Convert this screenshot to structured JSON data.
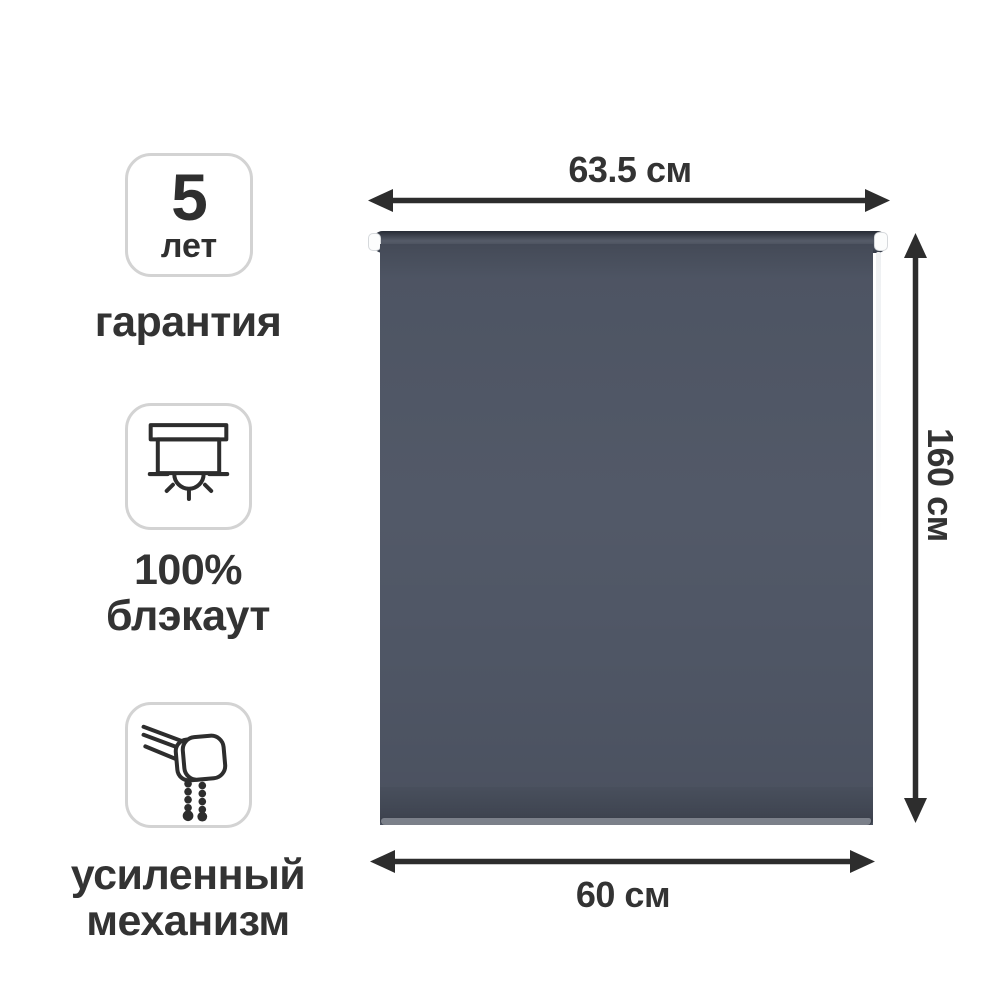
{
  "page": {
    "type": "product-infographic",
    "background": "#ffffff"
  },
  "product": {
    "item": "roller-blind",
    "fabric_color": "#4f5665",
    "roller_color": "#3a4150",
    "chain_color": "#eef0f2",
    "arrow_color": "#2d2d2d",
    "text_color": "#333333",
    "box_border_color": "#d3d3d3"
  },
  "features": [
    {
      "badge_number": "5",
      "badge_unit": "лет",
      "label_lines": [
        "гарантия"
      ]
    },
    {
      "icon": "blackout-blind-icon",
      "label_lines": [
        "100%",
        "блэкаут"
      ]
    },
    {
      "icon": "roller-mechanism-icon",
      "label_lines": [
        "усиленный",
        "механизм"
      ]
    }
  ],
  "dimensions": {
    "top": {
      "value": "63.5 см"
    },
    "right": {
      "value": "160 см"
    },
    "bottom": {
      "value": "60 см"
    }
  }
}
